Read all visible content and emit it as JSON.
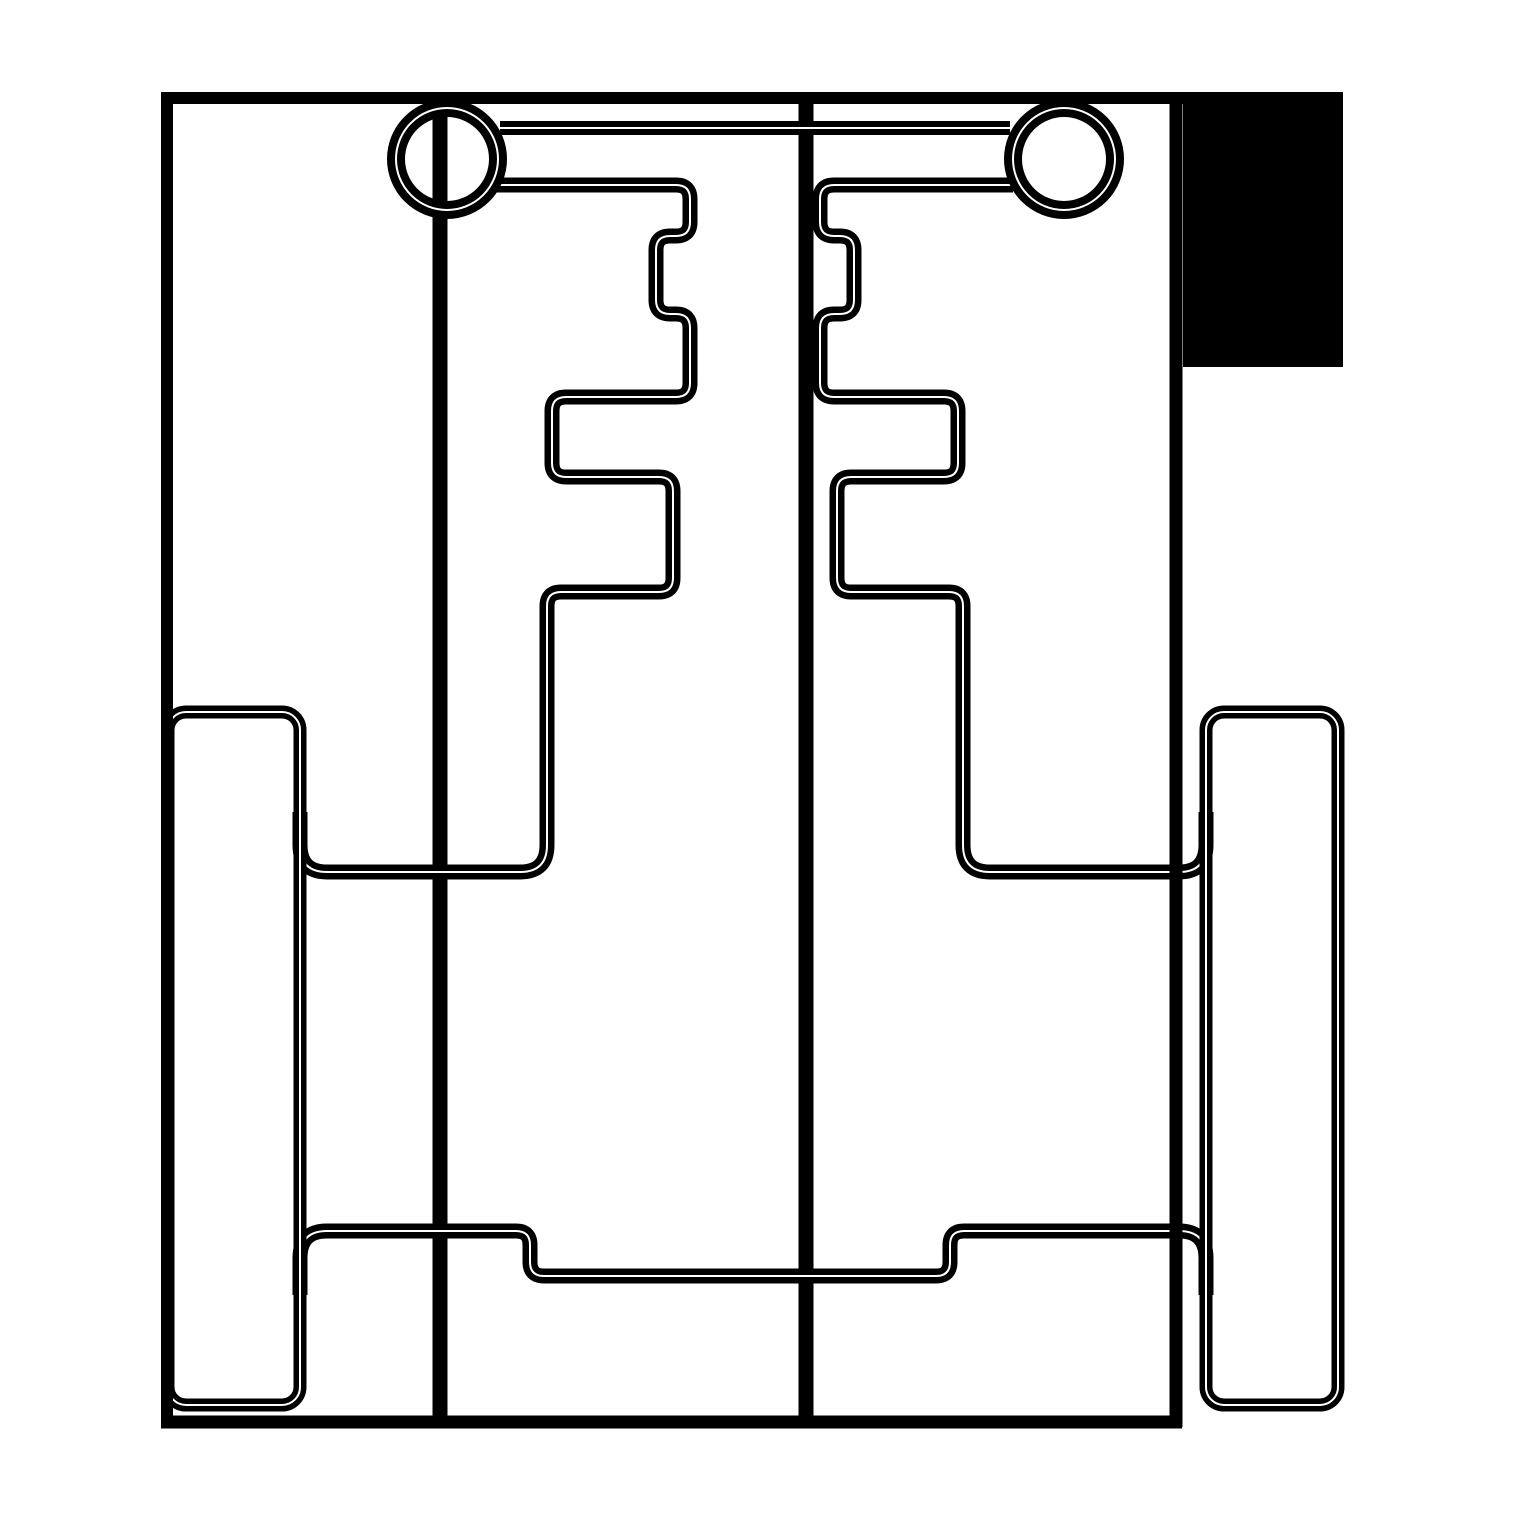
{
  "canvas": {
    "width": 1519,
    "height": 1519,
    "background_color": "#ffffff",
    "ink_color": "#000000",
    "kerf_color": "#ffffff",
    "kerf_width": 2
  },
  "shapes": [
    {
      "name": "filled-corner-block",
      "type": "rect",
      "x": 1183,
      "y": 92,
      "w": 160,
      "h": 275,
      "fill": "#000000",
      "stroke_width": 0,
      "kerf": false
    },
    {
      "name": "left-wheel-axis-vertical-line",
      "type": "line",
      "x1": 440,
      "y1": 92,
      "x2": 440,
      "y2": 1421,
      "stroke_width": 15,
      "kerf": false
    },
    {
      "name": "center-seam-vertical-line",
      "type": "line",
      "x1": 806,
      "y1": 92,
      "x2": 806,
      "y2": 1421,
      "stroke_width": 15,
      "kerf": false
    },
    {
      "name": "axle-bar-line",
      "type": "line",
      "x1": 500,
      "y1": 128,
      "x2": 1010,
      "y2": 128,
      "stroke_width": 14,
      "kerf": true
    },
    {
      "name": "left-keyway-path",
      "type": "path",
      "stroke_width": 15,
      "kerf": true,
      "d": "M 497 185 H 676 Q 690 185 690 199 V 222 Q 690 236 676 236 H 670 Q 656 236 656 250 V 300 Q 656 314 670 314 H 676 Q 690 314 690 328 V 383 Q 690 397 676 397 H 566 Q 552 397 552 411 V 463 Q 552 477 566 477 H 659 Q 673 477 673 491 V 578 Q 673 592 659 592 H 561 Q 547 592 547 606 V 845 Q 547 872 520 872 H 327 Q 300 872 300 845 V 812"
    },
    {
      "name": "right-keyway-path",
      "type": "path",
      "stroke_width": 15,
      "kerf": true,
      "d": "M 1013 185 H 834 Q 820 185 820 199 V 222 Q 820 236 834 236 H 840 Q 854 236 854 250 V 300 Q 854 314 840 314 H 834 Q 820 314 820 328 V 383 Q 820 397 834 397 H 944 Q 958 397 958 411 V 463 Q 958 477 944 477 H 851 Q 837 477 837 491 V 578 Q 837 592 851 592 H 949 Q 963 592 963 606 V 845 Q 963 872 990 872 H 1179 Q 1206 872 1206 845 V 812"
    },
    {
      "name": "bottom-step-joint-path",
      "type": "path",
      "stroke_width": 15,
      "kerf": true,
      "d": "M 300 1295 V 1258 Q 300 1231 327 1231 H 516 Q 530 1231 530 1245 V 1262 Q 530 1276 544 1276 H 936 Q 950 1276 950 1262 V 1245 Q 950 1231 964 1231 H 1179 Q 1206 1231 1206 1258 V 1295"
    },
    {
      "name": "left-foot-rounded-rect",
      "type": "rect",
      "x": 168,
      "y": 712,
      "w": 132,
      "h": 693,
      "rx": 18,
      "fill": "none",
      "stroke_width": 13,
      "kerf": true
    },
    {
      "name": "right-foot-rounded-rect",
      "type": "rect",
      "x": 1206,
      "y": 712,
      "w": 132,
      "h": 693,
      "rx": 18,
      "fill": "none",
      "stroke_width": 13,
      "kerf": true
    },
    {
      "name": "left-wheel-circle",
      "type": "circle",
      "cx": 447,
      "cy": 159,
      "r": 51,
      "stroke_width": 18,
      "kerf": true
    },
    {
      "name": "right-wheel-circle",
      "type": "circle",
      "cx": 1064,
      "cy": 159,
      "r": 51,
      "stroke_width": 18,
      "kerf": true
    },
    {
      "name": "frame-left-border-line",
      "type": "line",
      "x1": 167,
      "y1": 92,
      "x2": 167,
      "y2": 1427,
      "stroke_width": 12,
      "kerf": false
    },
    {
      "name": "frame-right-border-line",
      "type": "line",
      "x1": 1176,
      "y1": 92,
      "x2": 1176,
      "y2": 1427,
      "stroke_width": 13,
      "kerf": false
    },
    {
      "name": "frame-top-border-line",
      "type": "line",
      "x1": 161,
      "y1": 98,
      "x2": 1343,
      "y2": 98,
      "stroke_width": 12,
      "kerf": false
    },
    {
      "name": "frame-bottom-border-line",
      "type": "line",
      "x1": 161,
      "y1": 1422,
      "x2": 1182,
      "y2": 1422,
      "stroke_width": 13,
      "kerf": false
    }
  ]
}
